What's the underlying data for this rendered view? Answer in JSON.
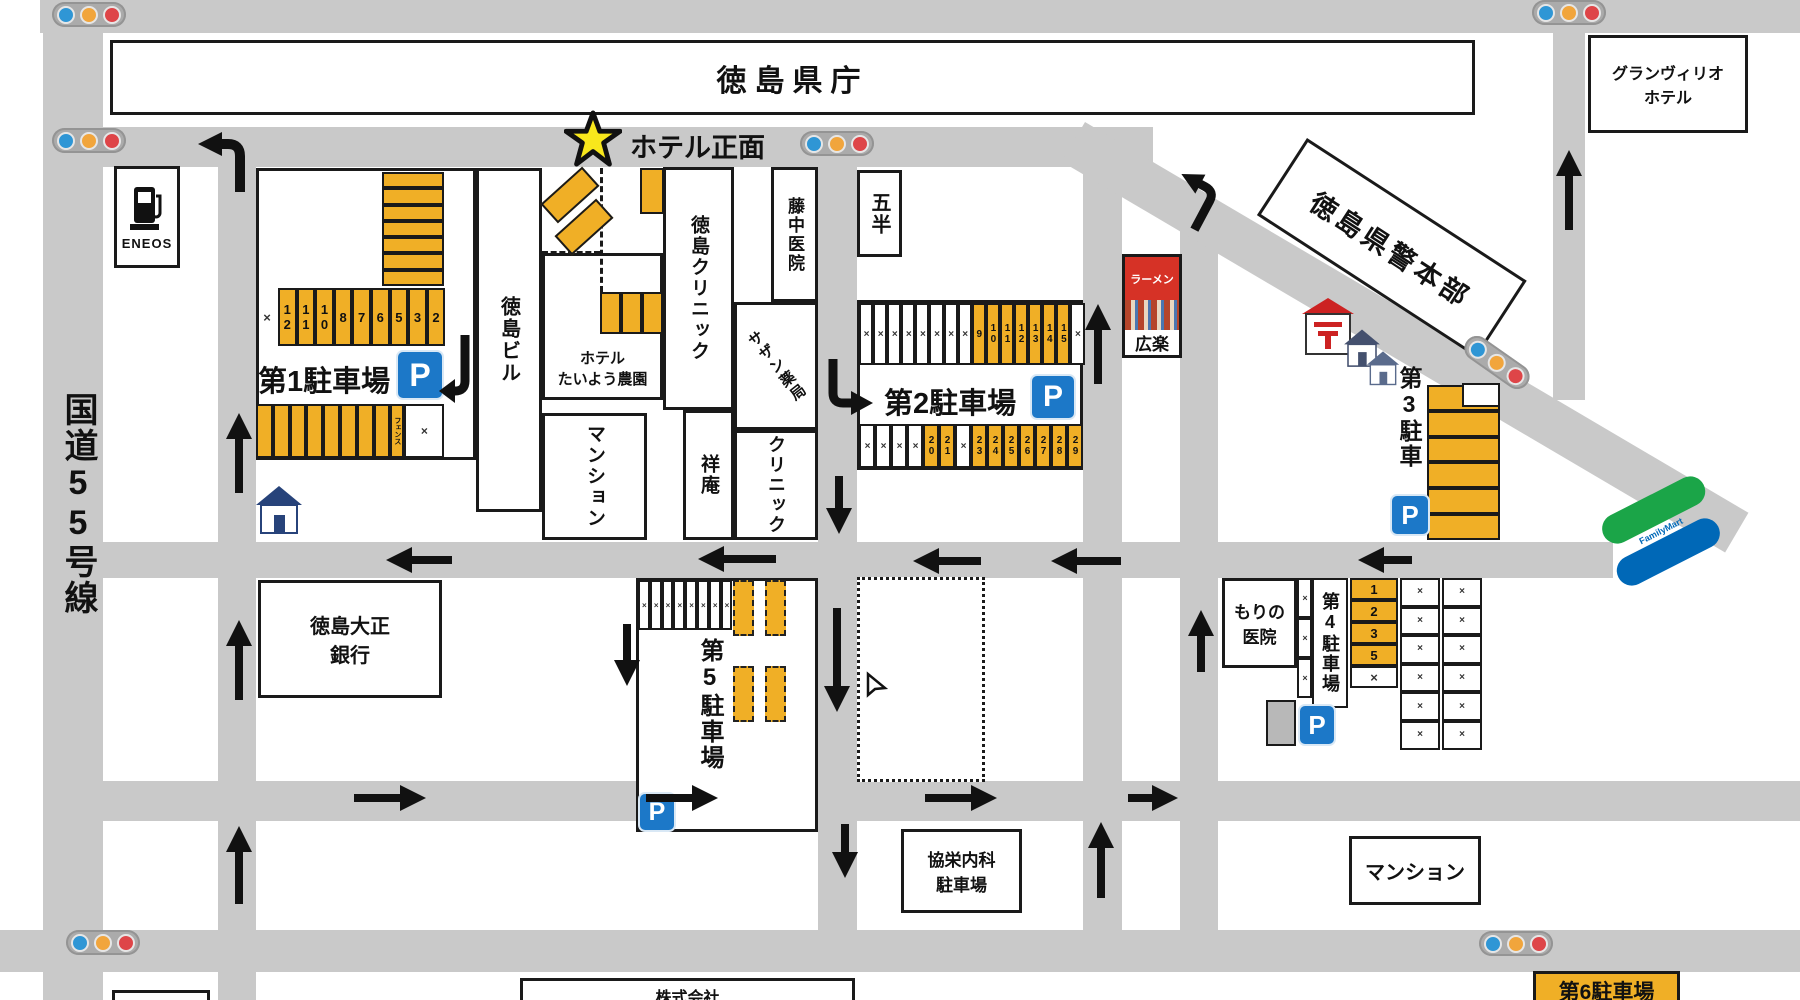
{
  "labels": {
    "prefectural_office": "徳島県庁",
    "granvrio_line1": "グランヴィリオ",
    "granvrio_line2": "ホテル",
    "police_hq": "徳島県警本部",
    "route55": "国道55号線",
    "eneos": "ENEOS",
    "hotel_front": "ホテル正面",
    "tokushima_bldg": "徳島ビル",
    "hotel_taiyo_line1": "ホテル",
    "hotel_taiyo_line2": "たいよう農園",
    "tokushima_clinic": "徳島クリニック",
    "fujinaka_clinic": "藤中医院",
    "southern_pharmacy": "サザン薬局",
    "gohan": "五半",
    "mansion_center": "マンション",
    "shoan": "祥庵",
    "clinic": "クリニック",
    "ramen": "ラーメン",
    "koraku": "広楽",
    "bank_line1": "徳島大正",
    "bank_line2": "銀行",
    "morino_line1": "もりの",
    "morino_line2": "医院",
    "kyoei_line1": "協栄内科",
    "kyoei_line2": "駐車場",
    "mansion_bottom": "マンション",
    "kabushiki": "株式会社",
    "familymart": "FamilyMart",
    "parking_mark": "P"
  },
  "lots": {
    "lot1": {
      "name": "第1駐車場",
      "stripes": [
        {
          "t": "",
          "open": true
        },
        {
          "t": "",
          "open": true
        },
        {
          "t": "",
          "open": true
        },
        {
          "t": "",
          "open": true
        },
        {
          "t": "",
          "open": true
        },
        {
          "t": "",
          "open": true
        },
        {
          "t": "",
          "open": true
        }
      ],
      "top_row": [
        {
          "t": "×",
          "open": false,
          "plain": true,
          "w": 22
        },
        {
          "t": "12",
          "open": true
        },
        {
          "t": "11",
          "open": true
        },
        {
          "t": "10",
          "open": true
        },
        {
          "t": "8",
          "open": true
        },
        {
          "t": "7",
          "open": true
        },
        {
          "t": "6",
          "open": true
        },
        {
          "t": "5",
          "open": true
        },
        {
          "t": "3",
          "open": true
        },
        {
          "t": "2",
          "open": true
        }
      ],
      "bottom_row": [
        {
          "t": "",
          "open": true
        },
        {
          "t": "",
          "open": true
        },
        {
          "t": "",
          "open": true
        },
        {
          "t": "",
          "open": true
        },
        {
          "t": "",
          "open": true
        },
        {
          "t": "",
          "open": true
        },
        {
          "t": "",
          "open": true
        },
        {
          "t": "",
          "open": true
        },
        {
          "t": "フェンス",
          "open": true,
          "small": true,
          "w": 14
        },
        {
          "t": "×",
          "open": false,
          "w": 40
        }
      ]
    },
    "lot2": {
      "name": "第2駐車場",
      "top_row": [
        {
          "t": "×",
          "open": false
        },
        {
          "t": "×",
          "open": false
        },
        {
          "t": "×",
          "open": false
        },
        {
          "t": "×",
          "open": false
        },
        {
          "t": "×",
          "open": false
        },
        {
          "t": "×",
          "open": false
        },
        {
          "t": "×",
          "open": false
        },
        {
          "t": "×",
          "open": false
        },
        {
          "t": "9",
          "open": true
        },
        {
          "t": "10",
          "open": true
        },
        {
          "t": "11",
          "open": true
        },
        {
          "t": "12",
          "open": true
        },
        {
          "t": "13",
          "open": true
        },
        {
          "t": "14",
          "open": true
        },
        {
          "t": "15",
          "open": true
        },
        {
          "t": "×",
          "open": false
        }
      ],
      "bottom_row": [
        {
          "t": "×",
          "open": false
        },
        {
          "t": "×",
          "open": false
        },
        {
          "t": "×",
          "open": false
        },
        {
          "t": "×",
          "open": false
        },
        {
          "t": "20",
          "open": true
        },
        {
          "t": "21",
          "open": true
        },
        {
          "t": "×",
          "open": false
        },
        {
          "t": "23",
          "open": true
        },
        {
          "t": "24",
          "open": true
        },
        {
          "t": "25",
          "open": true
        },
        {
          "t": "26",
          "open": true
        },
        {
          "t": "27",
          "open": true
        },
        {
          "t": "28",
          "open": true
        },
        {
          "t": "29",
          "open": true
        }
      ]
    },
    "lot3": {
      "name": "第3駐車",
      "cells": [
        {
          "t": "",
          "open": true
        },
        {
          "t": "",
          "open": true
        },
        {
          "t": "",
          "open": true
        },
        {
          "t": "",
          "open": true
        },
        {
          "t": "",
          "open": true
        },
        {
          "t": "",
          "open": true
        }
      ]
    },
    "lot4": {
      "name": "第4駐車場",
      "number_col": [
        {
          "t": "1",
          "open": true
        },
        {
          "t": "2",
          "open": true
        },
        {
          "t": "3",
          "open": true
        },
        {
          "t": "5",
          "open": true
        },
        {
          "t": "×",
          "open": false
        }
      ],
      "thin_col": [
        {
          "t": "×",
          "open": false
        },
        {
          "t": "×",
          "open": false
        },
        {
          "t": "×",
          "open": false
        }
      ],
      "right_col_a": [
        {
          "t": "×",
          "open": false
        },
        {
          "t": "×",
          "open": false
        },
        {
          "t": "×",
          "open": false
        },
        {
          "t": "×",
          "open": false
        },
        {
          "t": "×",
          "open": false
        },
        {
          "t": "×",
          "open": false
        }
      ],
      "right_col_b": [
        {
          "t": "×",
          "open": false
        },
        {
          "t": "×",
          "open": false
        },
        {
          "t": "×",
          "open": false
        },
        {
          "t": "×",
          "open": false
        },
        {
          "t": "×",
          "open": false
        },
        {
          "t": "×",
          "open": false
        }
      ]
    },
    "lot5": {
      "name": "第5駐車場",
      "white_row": [
        {
          "t": "×",
          "open": false
        },
        {
          "t": "×",
          "open": false
        },
        {
          "t": "×",
          "open": false
        },
        {
          "t": "×",
          "open": false
        },
        {
          "t": "×",
          "open": false
        },
        {
          "t": "×",
          "open": false
        },
        {
          "t": "×",
          "open": false
        },
        {
          "t": "×",
          "open": false
        }
      ],
      "dashed_cells": [
        {
          "t": "",
          "open": true,
          "dashed": true
        },
        {
          "t": "",
          "open": true,
          "dashed": true
        },
        {
          "t": "",
          "open": true,
          "dashed": true
        },
        {
          "t": "",
          "open": true,
          "dashed": true
        }
      ]
    },
    "lot6": {
      "name": "第6駐車場"
    }
  },
  "hotel_area": {
    "cells": [
      {
        "t": "",
        "open": true
      },
      {
        "t": "",
        "open": true
      },
      {
        "t": "",
        "open": true
      }
    ]
  },
  "arrows": [
    {
      "dir": "up",
      "x": 224,
      "y": 413,
      "len": 80
    },
    {
      "dir": "up",
      "x": 224,
      "y": 620,
      "len": 80
    },
    {
      "dir": "up",
      "x": 224,
      "y": 826,
      "len": 78
    },
    {
      "dir": "down",
      "x": 612,
      "y": 624,
      "len": 62
    },
    {
      "dir": "down",
      "x": 824,
      "y": 476,
      "len": 58
    },
    {
      "dir": "down",
      "x": 822,
      "y": 608,
      "len": 104
    },
    {
      "dir": "down",
      "x": 830,
      "y": 824,
      "len": 54
    },
    {
      "dir": "up",
      "x": 1083,
      "y": 304,
      "len": 80
    },
    {
      "dir": "up",
      "x": 1086,
      "y": 822,
      "len": 76
    },
    {
      "dir": "up",
      "x": 1186,
      "y": 610,
      "len": 62
    },
    {
      "dir": "up",
      "x": 1554,
      "y": 150,
      "len": 80
    },
    {
      "dir": "left",
      "x": 386,
      "y": 545,
      "len": 66
    },
    {
      "dir": "left",
      "x": 698,
      "y": 544,
      "len": 78
    },
    {
      "dir": "left",
      "x": 913,
      "y": 546,
      "len": 68
    },
    {
      "dir": "left",
      "x": 1051,
      "y": 546,
      "len": 70
    },
    {
      "dir": "left",
      "x": 1358,
      "y": 545,
      "len": 54
    },
    {
      "dir": "right",
      "x": 354,
      "y": 783,
      "len": 72
    },
    {
      "dir": "right",
      "x": 646,
      "y": 783,
      "len": 72
    },
    {
      "dir": "right",
      "x": 925,
      "y": 783,
      "len": 72
    },
    {
      "dir": "right",
      "x": 1128,
      "y": 783,
      "len": 50
    }
  ],
  "colors": {
    "road": "#c9c9c9",
    "spot_yellow": "#F0AF26",
    "parking_blue": "#1C78C8",
    "signal_blue": "#2F96D5",
    "signal_yellow": "#F1A53C",
    "signal_red": "#DE4548",
    "ramen_red": "#D63226",
    "familymart_green": "#1BA548",
    "familymart_blue": "#0068B7",
    "star_yellow": "#F8E71C"
  }
}
